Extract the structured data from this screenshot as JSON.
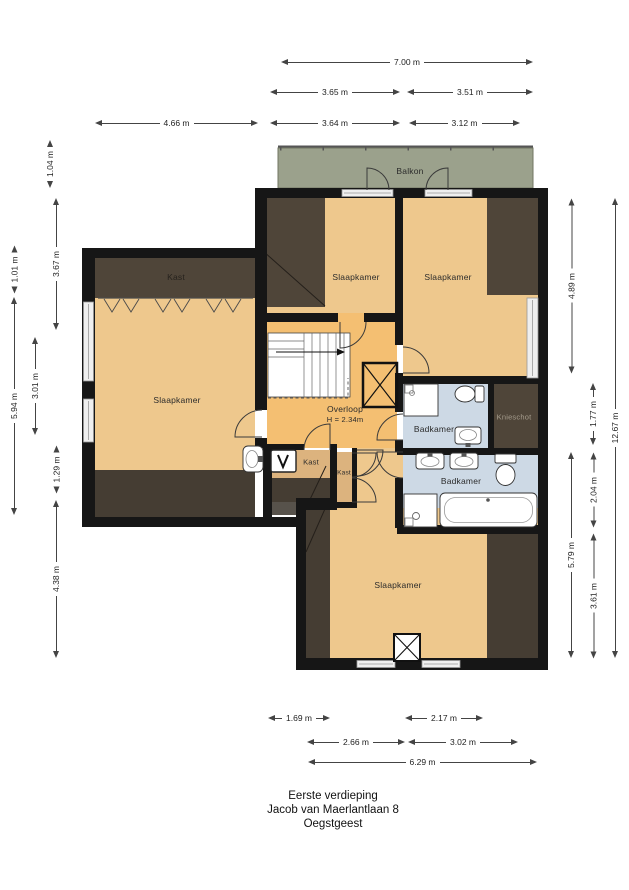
{
  "title": {
    "line1": "Eerste verdieping",
    "line2": "Jacob van Maerlantlaan 8",
    "line3": "Oegstgeest"
  },
  "colors": {
    "room": "#eec88d",
    "hall": "#f4bf72",
    "kast": "#dcb37e",
    "bath": "#cdd9e5",
    "closet": "#4f4539",
    "closet2": "#453d33",
    "balkon": "#9ba18c",
    "wall": "#161616",
    "window": "#efefef",
    "ink": "#222222"
  },
  "rooms": [
    {
      "name": "balkon",
      "label": "Balkon",
      "x": 410,
      "y": 171
    },
    {
      "name": "kast-topleft",
      "label": "Kast",
      "x": 176,
      "y": 277,
      "dark": true
    },
    {
      "name": "slaapkamer-left",
      "label": "Slaapkamer",
      "x": 177,
      "y": 400
    },
    {
      "name": "slaapkamer-mid",
      "label": "Slaapkamer",
      "x": 356,
      "y": 277
    },
    {
      "name": "slaapkamer-right",
      "label": "Slaapkamer",
      "x": 448,
      "y": 277
    },
    {
      "name": "overloop",
      "label": "Overloop",
      "sub": "H = 2.34m",
      "x": 345,
      "y": 414
    },
    {
      "name": "badkamer-1",
      "label": "Badkamer",
      "x": 434,
      "y": 429
    },
    {
      "name": "knieschot",
      "label": "Knieschot",
      "x": 514,
      "y": 417,
      "color": "#a69d8e",
      "size": 7.5
    },
    {
      "name": "kast-1",
      "label": "Kast",
      "x": 311,
      "y": 462,
      "size": 7.5
    },
    {
      "name": "kast-2",
      "label": "Kast",
      "x": 344,
      "y": 473,
      "size": 6.5
    },
    {
      "name": "badkamer-2",
      "label": "Badkamer",
      "x": 461,
      "y": 481
    },
    {
      "name": "slaapkamer-bottom",
      "label": "Slaapkamer",
      "x": 398,
      "y": 585
    }
  ],
  "dimensions": [
    {
      "label": "7.00 m",
      "orient": "h",
      "x": 281,
      "y": 62,
      "len": 252
    },
    {
      "label": "3.65 m",
      "orient": "h",
      "x": 270,
      "y": 92,
      "len": 130
    },
    {
      "label": "3.51 m",
      "orient": "h",
      "x": 407,
      "y": 92,
      "len": 126
    },
    {
      "label": "4.66 m",
      "orient": "h",
      "x": 95,
      "y": 123,
      "len": 163
    },
    {
      "label": "3.64 m",
      "orient": "h",
      "x": 270,
      "y": 123,
      "len": 130
    },
    {
      "label": "3.12 m",
      "orient": "h",
      "x": 409,
      "y": 123,
      "len": 111
    },
    {
      "label": "1.69 m",
      "orient": "h",
      "x": 268,
      "y": 718,
      "len": 62
    },
    {
      "label": "2.17 m",
      "orient": "h",
      "x": 405,
      "y": 718,
      "len": 78
    },
    {
      "label": "2.66 m",
      "orient": "h",
      "x": 307,
      "y": 742,
      "len": 98
    },
    {
      "label": "3.02 m",
      "orient": "h",
      "x": 408,
      "y": 742,
      "len": 110
    },
    {
      "label": "6.29 m",
      "orient": "h",
      "x": 308,
      "y": 762,
      "len": 229
    },
    {
      "label": "1.04 m",
      "orient": "v",
      "x": 50,
      "y": 148,
      "len": 40
    },
    {
      "label": "3.67 m",
      "orient": "v",
      "x": 56,
      "y": 198,
      "len": 132
    },
    {
      "label": "1.01 m",
      "orient": "v",
      "x": 14,
      "y": 258,
      "len": 35
    },
    {
      "label": "5.94 m",
      "orient": "v",
      "x": 14,
      "y": 297,
      "len": 218
    },
    {
      "label": "3.01 m",
      "orient": "v",
      "x": 35,
      "y": 337,
      "len": 98
    },
    {
      "label": "1.29 m",
      "orient": "v",
      "x": 56,
      "y": 450,
      "len": 43
    },
    {
      "label": "4.38 m",
      "orient": "v",
      "x": 56,
      "y": 500,
      "len": 158
    },
    {
      "label": "4.89 m",
      "orient": "v",
      "x": 571,
      "y": 198,
      "len": 175
    },
    {
      "label": "1.77 m",
      "orient": "v",
      "x": 593,
      "y": 383,
      "len": 62
    },
    {
      "label": "2.04 m",
      "orient": "v",
      "x": 593,
      "y": 452,
      "len": 75
    },
    {
      "label": "5.79 m",
      "orient": "v",
      "x": 571,
      "y": 452,
      "len": 206
    },
    {
      "label": "3.61 m",
      "orient": "v",
      "x": 593,
      "y": 533,
      "len": 125
    },
    {
      "label": "12.67 m",
      "orient": "v",
      "x": 615,
      "y": 198,
      "len": 460
    }
  ]
}
